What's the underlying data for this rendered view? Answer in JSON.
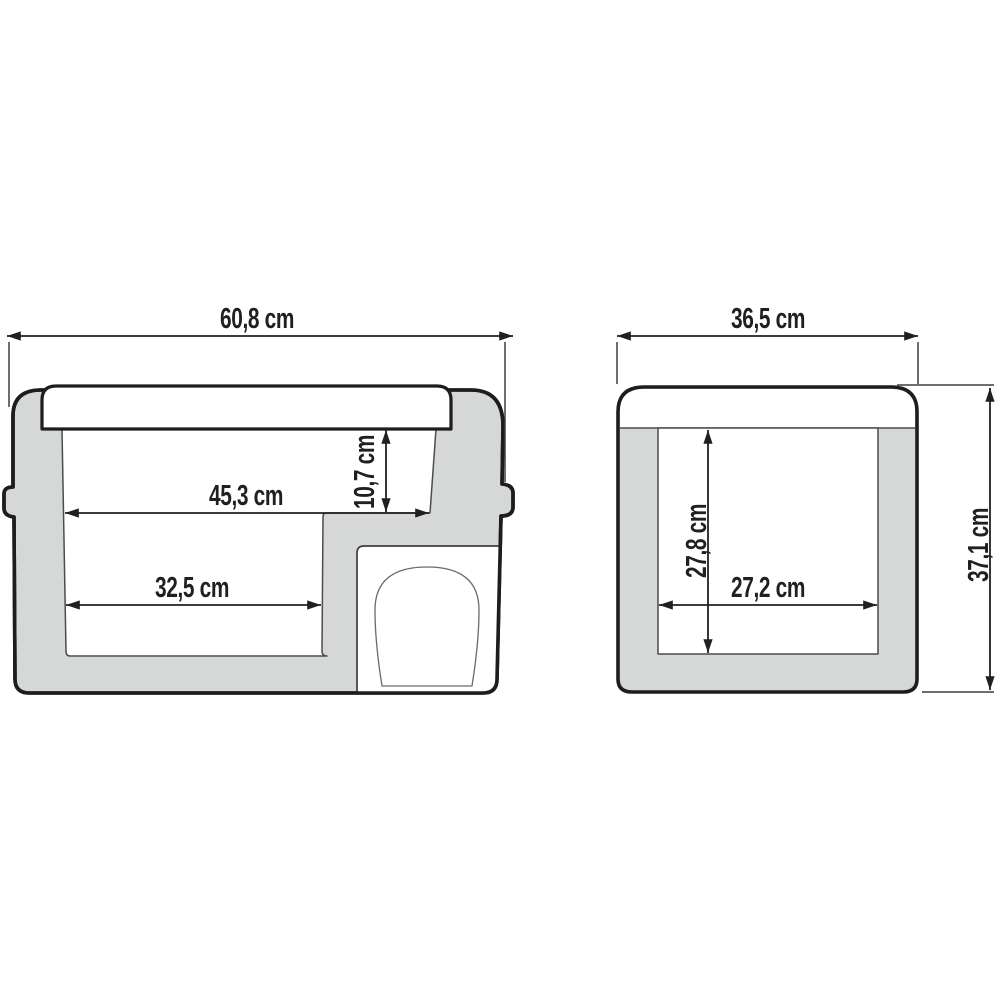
{
  "diagram": {
    "title": "compressor-cooler-dimension-drawing",
    "unit": "cm",
    "colors": {
      "background": "#ffffff",
      "body_fill": "#d5d8d7",
      "outline": "#1d1d20",
      "dim_color": "#231f20",
      "inner_line": "#4c4c4e",
      "white": "#ffffff"
    },
    "side_view": {
      "overall_width_label": "60,8 cm",
      "inner_upper_width_label": "45,3 cm",
      "inner_step_depth_label": "10,7 cm",
      "inner_lower_width_label": "32,5 cm"
    },
    "front_view": {
      "overall_width_label": "36,5 cm",
      "overall_height_label": "37,1 cm",
      "inner_height_label": "27,8 cm",
      "inner_width_label": "27,2 cm"
    }
  }
}
